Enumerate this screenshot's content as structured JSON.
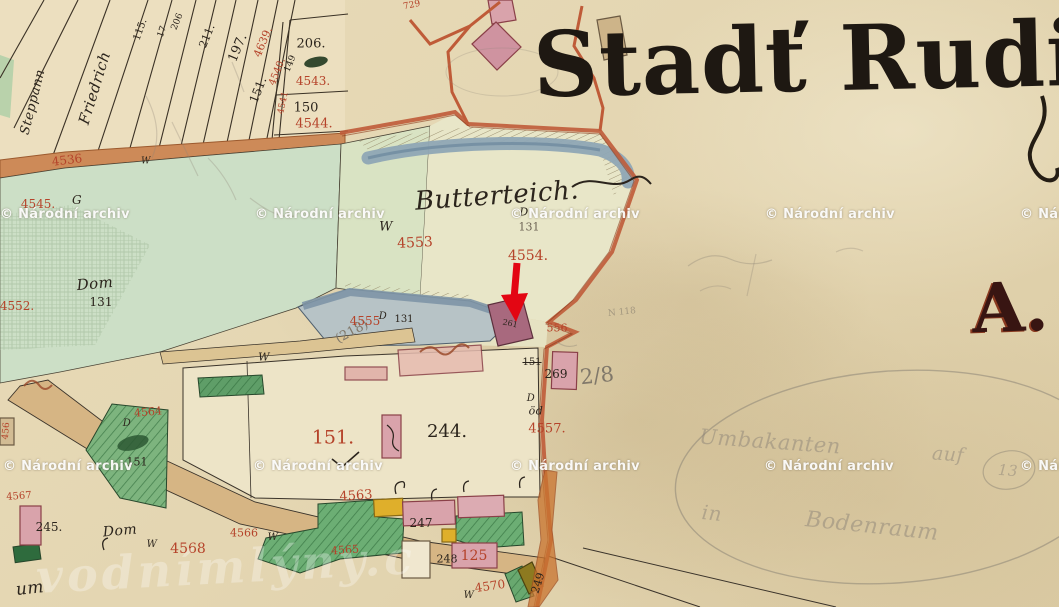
{
  "title": {
    "text": "Stadť Rudig"
  },
  "section_letter": {
    "text": "A."
  },
  "map_area_name": "Butterteich",
  "annotation_arrow": {
    "color": "#e30613",
    "tip_x": 515,
    "tip_y": 320,
    "points_at": "building parcel 556"
  },
  "colors": {
    "paper": "#e5d7b3",
    "road_orange": "#bf5b38",
    "water": "#8fa6b5",
    "meadow_green": "#ccdfc6",
    "garden_green": "#6cae74",
    "building_pink": "#d9a3ab",
    "building_dark": "#a8697e",
    "building_yellow": "#dfaf2b",
    "annotation_red": "#e30613",
    "parcel_number_red": "#b5432a",
    "ink": "#2b241c",
    "ink_faded": "#6d6354",
    "pencil": "#80786a",
    "pencil_faint": "#8d8478"
  },
  "watermark": {
    "text": "© Národní archiv",
    "positions": [
      [
        0,
        207
      ],
      [
        255,
        207
      ],
      [
        510,
        207
      ],
      [
        765,
        207
      ],
      [
        1020,
        207
      ],
      [
        3,
        459
      ],
      [
        253,
        459
      ],
      [
        510,
        459
      ],
      [
        764,
        459
      ],
      [
        1020,
        459
      ]
    ]
  },
  "site_watermark": {
    "text": "vodnímlýny.c"
  },
  "labels": [
    {
      "t": "Steppann",
      "x": 33,
      "y": 102,
      "s": 13,
      "r": -76,
      "c": "ink",
      "f": 1
    },
    {
      "t": "Friedrich",
      "x": 95,
      "y": 88,
      "s": 15,
      "r": -73,
      "c": "ink",
      "f": 1
    },
    {
      "t": "115.",
      "x": 141,
      "y": 30,
      "s": 10,
      "r": -70,
      "c": "ink"
    },
    {
      "t": "17",
      "x": 163,
      "y": 32,
      "s": 9,
      "r": -70,
      "c": "ink"
    },
    {
      "t": "206",
      "x": 178,
      "y": 22,
      "s": 9,
      "r": -68,
      "c": "ink"
    },
    {
      "t": "211.",
      "x": 207,
      "y": 36,
      "s": 11,
      "r": -68,
      "c": "ink"
    },
    {
      "t": "197.",
      "x": 238,
      "y": 48,
      "s": 13,
      "r": -67,
      "c": "ink"
    },
    {
      "t": "4639.",
      "x": 263,
      "y": 42,
      "s": 11,
      "r": -67,
      "c": "red"
    },
    {
      "t": "151.",
      "x": 258,
      "y": 90,
      "s": 12,
      "r": -68,
      "c": "ink"
    },
    {
      "t": "4540.",
      "x": 278,
      "y": 72,
      "s": 10,
      "r": -68,
      "c": "red"
    },
    {
      "t": "149",
      "x": 291,
      "y": 64,
      "s": 9,
      "r": -68,
      "c": "ink"
    },
    {
      "t": "4541",
      "x": 284,
      "y": 103,
      "s": 9,
      "r": -78,
      "c": "red"
    },
    {
      "t": "206.",
      "x": 311,
      "y": 44,
      "s": 13,
      "c": "ink"
    },
    {
      "t": "4543.",
      "x": 313,
      "y": 81,
      "s": 12,
      "c": "red"
    },
    {
      "t": "150",
      "x": 306,
      "y": 108,
      "s": 13,
      "c": "ink"
    },
    {
      "t": "4544.",
      "x": 314,
      "y": 124,
      "s": 13,
      "c": "red"
    },
    {
      "t": "729",
      "x": 412,
      "y": 6,
      "s": 9,
      "r": -12,
      "c": "red"
    },
    {
      "t": "4536",
      "x": 67,
      "y": 160,
      "s": 12,
      "r": -7,
      "c": "red"
    },
    {
      "t": "W",
      "x": 146,
      "y": 162,
      "s": 9,
      "c": "ink",
      "f": 1
    },
    {
      "t": "4545.",
      "x": 38,
      "y": 204,
      "s": 12,
      "c": "red"
    },
    {
      "t": "G",
      "x": 77,
      "y": 200,
      "s": 12,
      "c": "ink",
      "f": 1
    },
    {
      "t": "4552.",
      "x": 17,
      "y": 306,
      "s": 12,
      "c": "red"
    },
    {
      "t": "Dom",
      "x": 95,
      "y": 284,
      "s": 15,
      "r": -5,
      "c": "ink",
      "f": 1
    },
    {
      "t": "131",
      "x": 101,
      "y": 302,
      "s": 12,
      "c": "ink"
    },
    {
      "t": "Butterteich.",
      "x": 497,
      "y": 196,
      "s": 26,
      "r": -4,
      "c": "ink",
      "f": 1
    },
    {
      "t": "W",
      "x": 386,
      "y": 227,
      "s": 13,
      "c": "ink",
      "f": 1
    },
    {
      "t": "D",
      "x": 524,
      "y": 212,
      "s": 11,
      "c": "ink",
      "f": 1
    },
    {
      "t": "131",
      "x": 529,
      "y": 227,
      "s": 11,
      "c": "faded"
    },
    {
      "t": "4553",
      "x": 415,
      "y": 243,
      "s": 14,
      "r": -3,
      "c": "red"
    },
    {
      "t": "4554.",
      "x": 528,
      "y": 256,
      "s": 14,
      "c": "red"
    },
    {
      "t": "(218)",
      "x": 352,
      "y": 332,
      "s": 13,
      "r": -28,
      "c": "pencil"
    },
    {
      "t": "4555",
      "x": 365,
      "y": 321,
      "s": 12,
      "c": "red"
    },
    {
      "t": "D",
      "x": 383,
      "y": 317,
      "s": 10,
      "c": "ink",
      "f": 1
    },
    {
      "t": "131",
      "x": 404,
      "y": 320,
      "s": 10,
      "c": "ink"
    },
    {
      "t": "W",
      "x": 264,
      "y": 357,
      "s": 11,
      "c": "ink",
      "f": 1
    },
    {
      "t": "261",
      "x": 510,
      "y": 324,
      "s": 8,
      "r": 12,
      "c": "ink"
    },
    {
      "t": "556",
      "x": 557,
      "y": 328,
      "s": 11,
      "c": "red"
    },
    {
      "t": "151",
      "x": 532,
      "y": 363,
      "s": 10,
      "c": "ink",
      "st": 1
    },
    {
      "t": "269",
      "x": 556,
      "y": 374,
      "s": 12,
      "c": "ink"
    },
    {
      "t": "2/8",
      "x": 597,
      "y": 376,
      "s": 21,
      "r": -6,
      "c": "pencil"
    },
    {
      "t": "N 118",
      "x": 622,
      "y": 313,
      "s": 9,
      "r": -6,
      "c": "pencil",
      "o": 0.6
    },
    {
      "t": "D",
      "x": 531,
      "y": 399,
      "s": 10,
      "c": "ink",
      "f": 1
    },
    {
      "t": "öd",
      "x": 536,
      "y": 411,
      "s": 11,
      "c": "ink",
      "f": 1
    },
    {
      "t": "4557.",
      "x": 547,
      "y": 429,
      "s": 13,
      "c": "red"
    },
    {
      "t": "151.",
      "x": 333,
      "y": 438,
      "s": 19,
      "c": "red"
    },
    {
      "t": "244.",
      "x": 447,
      "y": 432,
      "s": 18,
      "c": "ink"
    },
    {
      "t": "4563",
      "x": 356,
      "y": 496,
      "s": 13,
      "r": -4,
      "c": "red"
    },
    {
      "t": "247",
      "x": 421,
      "y": 523,
      "s": 12,
      "c": "ink"
    },
    {
      "t": "248",
      "x": 447,
      "y": 559,
      "s": 11,
      "c": "ink"
    },
    {
      "t": "125",
      "x": 474,
      "y": 556,
      "s": 14,
      "c": "red"
    },
    {
      "t": "4565",
      "x": 345,
      "y": 550,
      "s": 11,
      "r": -4,
      "c": "red"
    },
    {
      "t": "4570",
      "x": 490,
      "y": 586,
      "s": 12,
      "r": -8,
      "c": "red"
    },
    {
      "t": "W",
      "x": 469,
      "y": 596,
      "s": 10,
      "c": "ink",
      "f": 1
    },
    {
      "t": "249",
      "x": 538,
      "y": 583,
      "s": 11,
      "r": -72,
      "c": "ink"
    },
    {
      "t": "4564",
      "x": 148,
      "y": 412,
      "s": 11,
      "r": -5,
      "c": "red"
    },
    {
      "t": "D",
      "x": 127,
      "y": 424,
      "s": 10,
      "c": "ink",
      "f": 1
    },
    {
      "t": "151",
      "x": 137,
      "y": 462,
      "s": 11,
      "c": "ink"
    },
    {
      "t": "245.",
      "x": 49,
      "y": 527,
      "s": 12,
      "c": "ink"
    },
    {
      "t": "Dom",
      "x": 120,
      "y": 531,
      "s": 14,
      "r": -5,
      "c": "ink",
      "f": 1
    },
    {
      "t": "W",
      "x": 152,
      "y": 545,
      "s": 10,
      "c": "ink",
      "f": 1
    },
    {
      "t": "4568",
      "x": 188,
      "y": 549,
      "s": 14,
      "c": "red"
    },
    {
      "t": "4566",
      "x": 244,
      "y": 533,
      "s": 11,
      "c": "red"
    },
    {
      "t": "W",
      "x": 273,
      "y": 538,
      "s": 10,
      "c": "ink",
      "f": 1
    },
    {
      "t": "4567",
      "x": 19,
      "y": 497,
      "s": 10,
      "r": -4,
      "c": "red"
    },
    {
      "t": "456",
      "x": 7,
      "y": 431,
      "s": 9,
      "r": -85,
      "c": "red"
    },
    {
      "t": "um",
      "x": 30,
      "y": 589,
      "s": 17,
      "r": -6,
      "c": "ink",
      "f": 1
    },
    {
      "t": "Umbakanten",
      "x": 770,
      "y": 442,
      "s": 21,
      "r": 4,
      "c": "faint",
      "f": 1,
      "o": 0.5
    },
    {
      "t": "auf",
      "x": 948,
      "y": 455,
      "s": 19,
      "r": 4,
      "c": "faint",
      "f": 1,
      "o": 0.5
    },
    {
      "t": "13",
      "x": 1008,
      "y": 471,
      "s": 15,
      "r": 4,
      "c": "faint",
      "f": 1,
      "o": 0.5
    },
    {
      "t": "in",
      "x": 712,
      "y": 513,
      "s": 20,
      "r": 6,
      "c": "faint",
      "f": 1,
      "o": 0.5
    },
    {
      "t": "Bodenraum",
      "x": 872,
      "y": 527,
      "s": 22,
      "r": 6,
      "c": "faint",
      "f": 1,
      "o": 0.5
    }
  ]
}
